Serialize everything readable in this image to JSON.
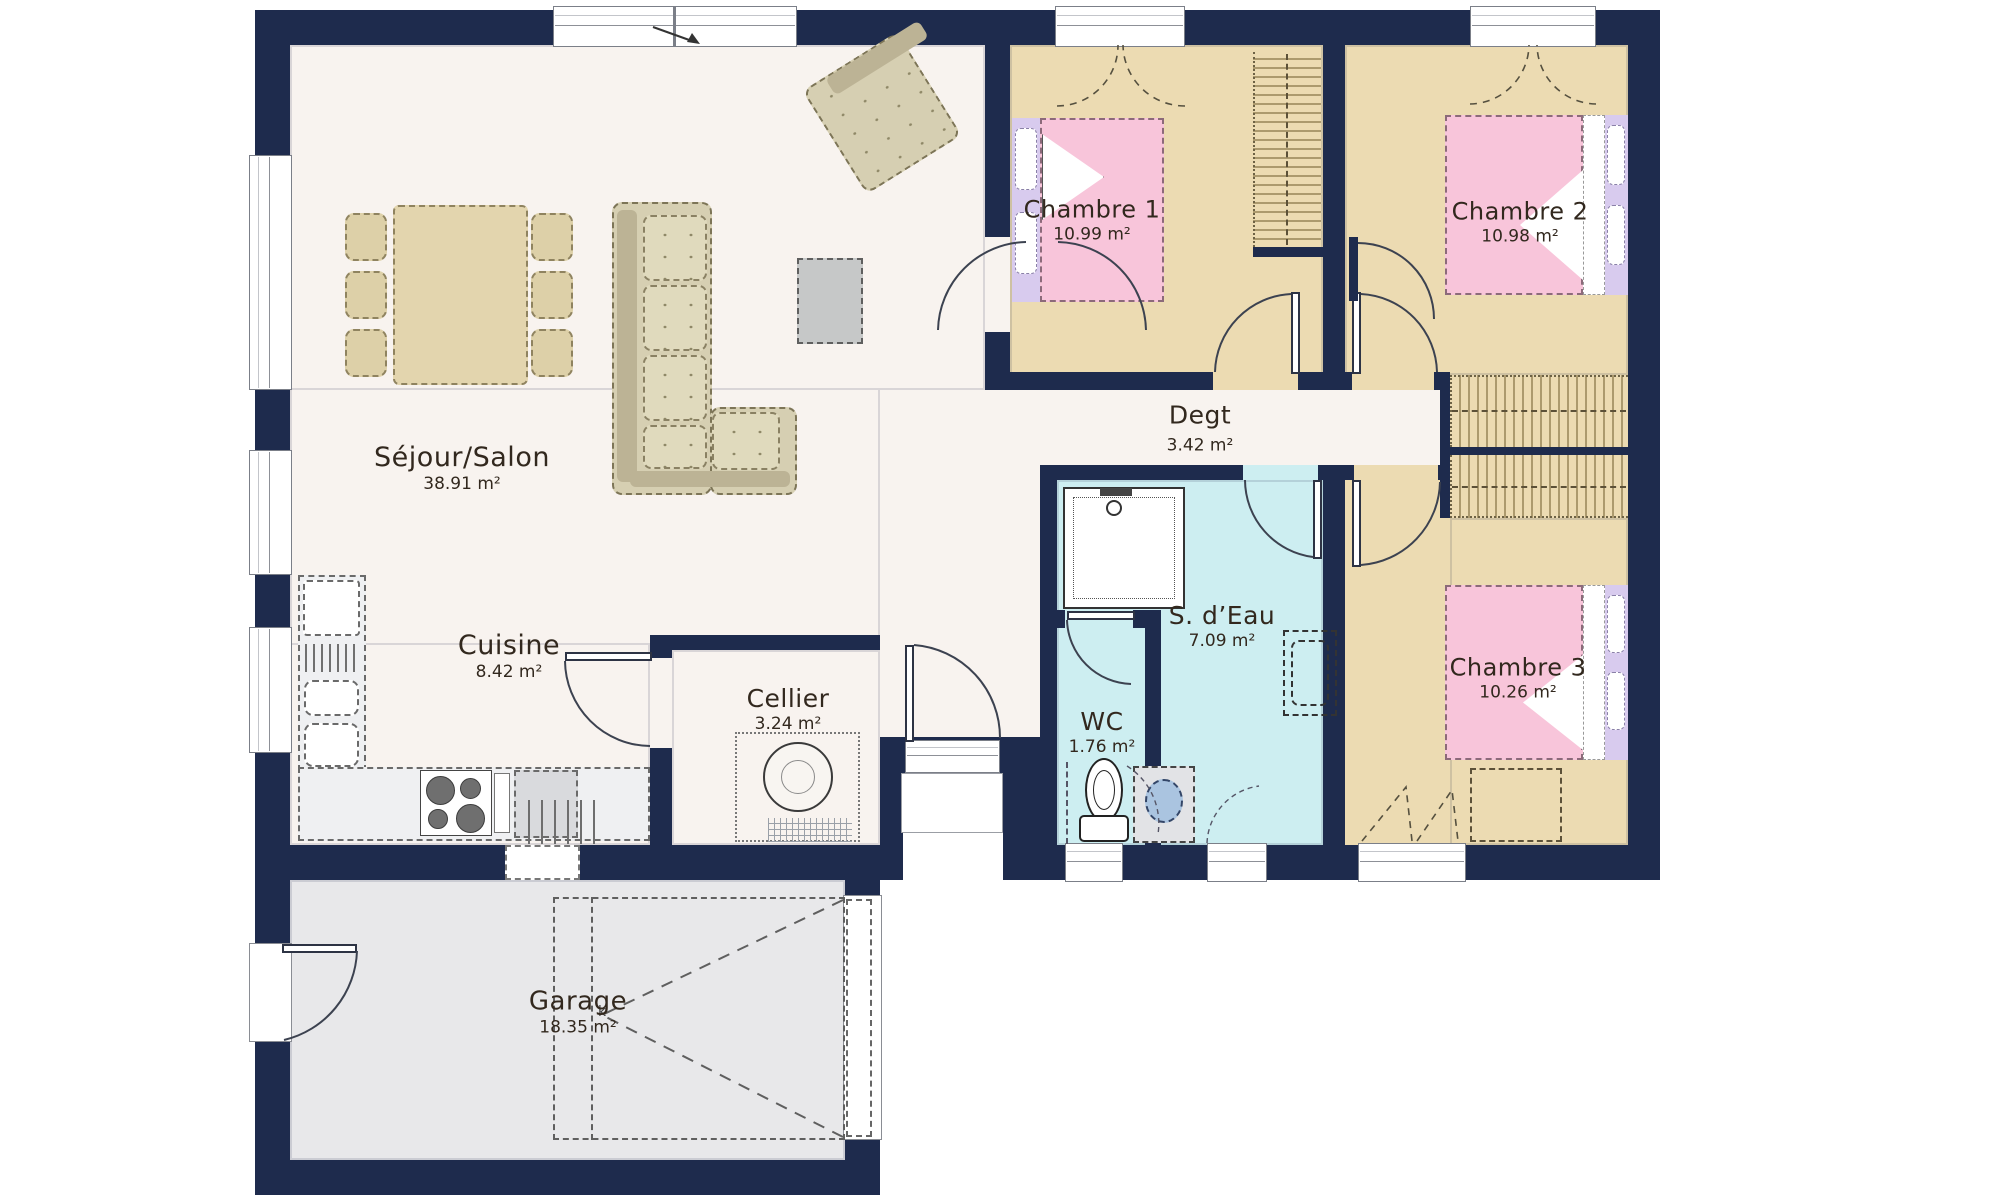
{
  "rooms": [
    {
      "id": "sejour-salon",
      "name": "Séjour/Salon",
      "area": "38.91 m²"
    },
    {
      "id": "cuisine",
      "name": "Cuisine",
      "area": "8.42 m²"
    },
    {
      "id": "cellier",
      "name": "Cellier",
      "area": "3.24 m²"
    },
    {
      "id": "garage",
      "name": "Garage",
      "area": "18.35 m²"
    },
    {
      "id": "chambre-1",
      "name": "Chambre 1",
      "area": "10.99 m²"
    },
    {
      "id": "chambre-2",
      "name": "Chambre 2",
      "area": "10.98 m²"
    },
    {
      "id": "chambre-3",
      "name": "Chambre 3",
      "area": "10.26 m²"
    },
    {
      "id": "degagement",
      "name": "Degt",
      "area": "3.42 m²"
    },
    {
      "id": "salle-d-eau",
      "name": "S. d’Eau",
      "area": "7.09 m²"
    },
    {
      "id": "wc",
      "name": "WC",
      "area": "1.76 m²"
    }
  ],
  "marks": {
    "garage_door": "k"
  },
  "colors": {
    "wall": "#1e2b4d",
    "living_floor": "#f8f3ef",
    "bedroom_floor": "#ecdbb2",
    "bathroom_floor": "#cdeef1",
    "garage_floor": "#e8e8ea",
    "bed_pink": "#f8c5da",
    "lavender": "#d8cbee",
    "sofa_beige": "#d6cfb2",
    "table_wood": "#e3d5ae",
    "counter_gray": "#d9dadd",
    "washer_blue": "#aac4e0"
  }
}
